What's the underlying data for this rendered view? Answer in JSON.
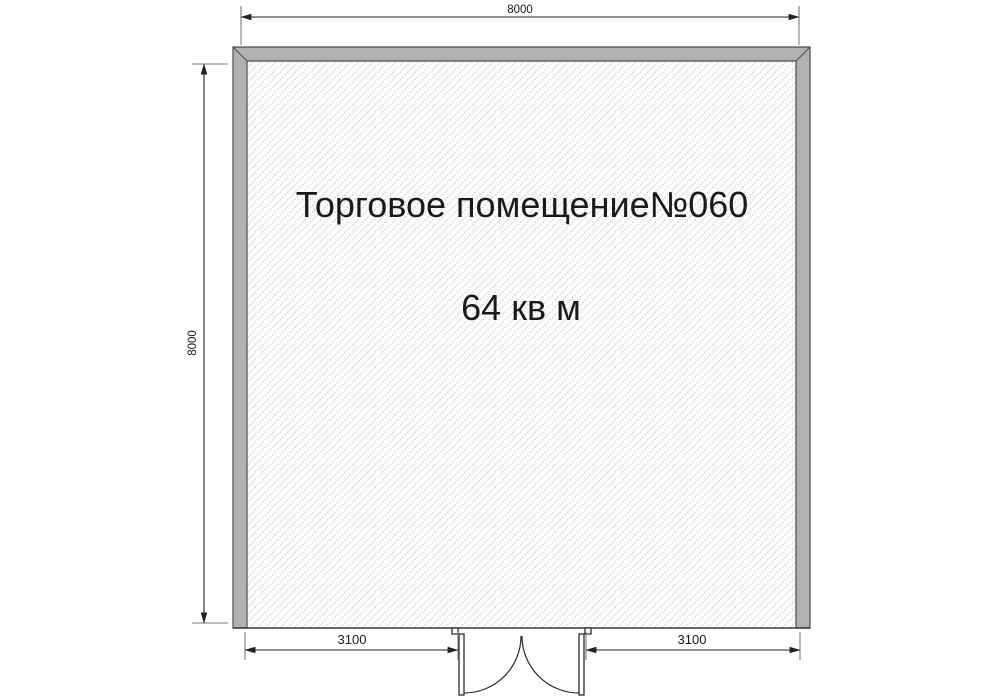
{
  "plan": {
    "room_label": "Торговое помещение№060",
    "room_area": "64 кв м",
    "dimensions": {
      "top_width_mm": "8000",
      "left_height_mm": "8000",
      "bottom_left_mm": "3100",
      "bottom_right_mm": "3100"
    },
    "door": {
      "type": "double-swing-door",
      "leaves": 2
    },
    "colors": {
      "wall_fill": "#b1b1b1",
      "wall_outline": "#4d4d4d",
      "hatch_line": "#c3ccc2",
      "interior_bg": "#fcfcfa",
      "dimension_line": "#222222",
      "text": "#1a1a1a"
    }
  }
}
